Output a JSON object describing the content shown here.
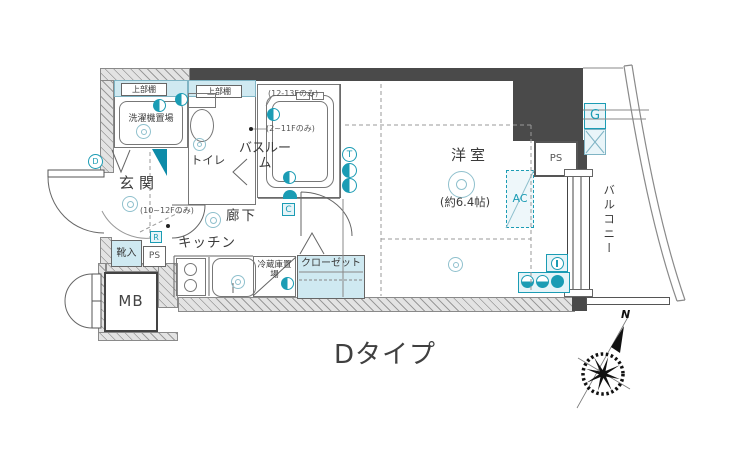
{
  "title": "Dタイプ",
  "compass": {
    "north": "N"
  },
  "plan": {
    "laundry": {
      "shelf": "上部棚",
      "name": "洗濯機置場"
    },
    "toilet": {
      "shelf": "上部棚",
      "name": "トイレ"
    },
    "bath": {
      "name": "バスルーム",
      "note_floor_high": "(12-13Fのみ)",
      "note_floor_low": "(2~11Fのみ)"
    },
    "entrance": {
      "name": "玄関",
      "note_floor": "(10~12Fのみ)"
    },
    "shoe_cabinet": {
      "name": "靴入"
    },
    "pipe_space_entrance": {
      "name": "PS"
    },
    "meter_box": {
      "name": "MB"
    },
    "corridor": {
      "name": "廊下"
    },
    "kitchen": {
      "name": "キッチン"
    },
    "refrigerator": {
      "name": "冷蔵庫置場"
    },
    "closet": {
      "name": "クローゼット"
    },
    "main_room": {
      "name": "洋室",
      "size": "(約6.4帖)"
    },
    "air_conditioner": {
      "name": "AC"
    },
    "pipe_space_balcony": {
      "name": "PS"
    },
    "gas_meter": {
      "name": "G"
    },
    "balcony": {
      "name": "バルコニー"
    }
  },
  "badges": {
    "d": "D",
    "r": "R",
    "c": "C",
    "t": "T"
  },
  "icons": {
    "compass": "compass-rose",
    "ceiling_light": "double-circle",
    "outlet": "half-filled-circle",
    "door_swing": "quarter-arc"
  },
  "colors": {
    "accent_teal": "#1b9cb4",
    "teal_fill": "#cfe9f1",
    "wall_dark": "#4a4a4a",
    "wall_hatch": "#e3e3e3"
  }
}
